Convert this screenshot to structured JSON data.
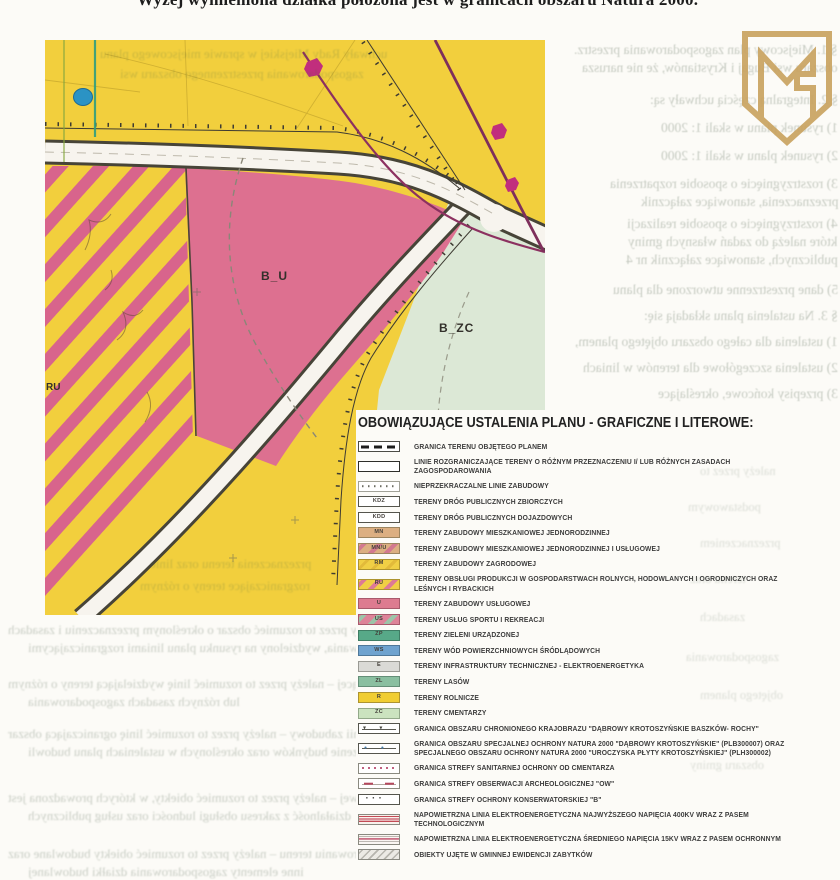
{
  "header": {
    "title": "Wyżej wymieniona działka położona jest w granicach obszaru Natura 2000."
  },
  "logo": {
    "name": "gold-shield-monogram",
    "color": "#C9A25E"
  },
  "map": {
    "area_labels": {
      "bu": "B_U",
      "bzc": "B_ZC",
      "ru": "RU"
    },
    "colors": {
      "farmland_yellow": "#F2CF3D",
      "services_pink": "#DD7090",
      "cemetery_green": "#DCE8D6",
      "hatch_stripe_pink": "#D8648C",
      "road_white": "#F7F4EE",
      "outline_dark": "#474438",
      "power_line_purple": "#8C3160",
      "monument_magenta": "#C12E7D",
      "pond_blue": "#2B93C4",
      "stream_teal": "#2F9E80"
    }
  },
  "legend": {
    "title": "OBOWIĄZUJĄCE USTALENIA PLANU - GRAFICZNE I LITEROWE:",
    "items": [
      {
        "swatch": "dash-bold",
        "code": "",
        "label": "GRANICA TERENU OBJĘTEGO PLANEM"
      },
      {
        "swatch": "outline",
        "code": "",
        "label": "LINIE ROZGRANICZAJĄCE TERENY O RÓŻNYM PRZEZNACZENIU I/ LUB RÓŻNYCH ZASADACH ZAGOSPODAROWANIA"
      },
      {
        "swatch": "dotted",
        "code": "",
        "label": "NIEPRZEKRACZALNE LINIE ZABUDOWY"
      },
      {
        "swatch": "road",
        "code": "KDZ",
        "label": "TERENY DRÓG PUBLICZNYCH ZBIORCZYCH"
      },
      {
        "swatch": "road",
        "code": "KDD",
        "label": "TERENY DRÓG PUBLICZNYCH DOJAZDOWYCH"
      },
      {
        "swatch": "fill-tan",
        "code": "MN",
        "label": "TERENY ZABUDOWY MIESZKANIOWEJ JEDNORODZINNEJ"
      },
      {
        "swatch": "fill-tan-stripe",
        "code": "MN/U",
        "label": "TERENY ZABUDOWY MIESZKANIOWEJ JEDNORODZINNEJ I USŁUGOWEJ"
      },
      {
        "swatch": "fill-yellow-soft",
        "code": "RM",
        "label": "TERENY ZABUDOWY ZAGRODOWEJ"
      },
      {
        "swatch": "fill-yellow-stripe-pink",
        "code": "RU",
        "label": "TERENY OBSŁUGI PRODUKCJI W GOSPODARSTWACH ROLNYCH, HODOWLANYCH I OGRODNICZYCH ORAZ LEŚNYCH I RYBACKICH"
      },
      {
        "swatch": "fill-pink",
        "code": "U",
        "label": "TERENY ZABUDOWY USŁUGOWEJ"
      },
      {
        "swatch": "fill-pink-stripe-green",
        "code": "US",
        "label": "TERENY USŁUG SPORTU I REKREACJI"
      },
      {
        "swatch": "fill-teal",
        "code": "ZP",
        "label": "TERENY ZIELENI URZĄDZONEJ"
      },
      {
        "swatch": "fill-blue",
        "code": "WS",
        "label": "TERENY WÓD POWIERZCHNIOWYCH ŚRÓDLĄDOWYCH"
      },
      {
        "swatch": "fill-gray",
        "code": "E",
        "label": "TERENY INFRASTRUKTURY TECHNICZNEJ - ELEKTROENERGETYKA"
      },
      {
        "swatch": "fill-green",
        "code": "ZL",
        "label": "TERENY LASÓW"
      },
      {
        "swatch": "fill-yellow",
        "code": "R",
        "label": "TERENY ROLNICZE"
      },
      {
        "swatch": "fill-lightgreen",
        "code": "ZC",
        "label": "TERENY CMENTARZY"
      },
      {
        "swatch": "marker-tri",
        "code": "",
        "label": "GRANICA OBSZARU CHRONIONEGO KRAJOBRAZU \"DĄBROWY KROTOSZYŃSKIE BASZKÓW- ROCHY\""
      },
      {
        "swatch": "marker-dot",
        "code": "",
        "label": "GRANICA OBSZARU SPECJALNEJ OCHRONY NATURA 2000 \"DĄBROWY KROTOSZYŃSKIE\" (PLB300007) ORAZ SPECJALNEGO OBSZARU OCHRONY NATURA 2000 \"UROCZYSKA PŁYTY KROTOSZYŃSKIEJ\" (PLH300002)"
      },
      {
        "swatch": "sanitary",
        "code": "",
        "label": "GRANICA STREFY SANITARNEJ OCHRONY OD CMENTARZA"
      },
      {
        "swatch": "arch",
        "code": "",
        "label": "GRANICA STREFY OBSERWACJI ARCHEOLOGICZNEJ \"OW\""
      },
      {
        "swatch": "conserv",
        "code": "",
        "label": "GRANICA STREFY OCHRONY KONSERWATORSKIEJ \"B\""
      },
      {
        "swatch": "hv400",
        "code": "",
        "label": "NAPOWIETRZNA LINIA ELEKTROENERGETYCZNA NAJWYŻSZEGO NAPIĘCIA 400KV WRAZ Z PASEM TECHNOLOGICZNYM"
      },
      {
        "swatch": "mv15",
        "code": "",
        "label": "NAPOWIETRZNA LINIA ELEKTROENERGETYCZNA ŚREDNIEGO NAPIĘCIA 15KV WRAZ Z PASEM OCHRONNYM"
      },
      {
        "swatch": "hatch-gray",
        "code": "",
        "label": "OBIEKTY UJĘTE W GMINNEJ EWIDENCJI ZABYTKÓW"
      }
    ]
  },
  "bleedthrough": {
    "note": "faint mirrored show-through text from reverse side of scanned page",
    "right_column": [
      {
        "y": 42,
        "r": 2,
        "t": "§ 1. Miejscowy plan zagospodarowania przestrz."
      },
      {
        "y": 60,
        "r": 2,
        "t": "obszaru wsi Bugaj i Krystianów, że nie narusza"
      },
      {
        "y": 92,
        "r": 2,
        "t": "§ 2. Integralną częścią uchwały są:"
      },
      {
        "y": 120,
        "r": 2,
        "t": "1) rysunek planu w skali 1: 2000"
      },
      {
        "y": 148,
        "r": 2,
        "t": "2) rysunek planu w skali 1: 2000"
      },
      {
        "y": 176,
        "r": 2,
        "t": "3) rozstrzygnięcie o sposobie rozpatrzenia"
      },
      {
        "y": 194,
        "r": 2,
        "t": "przeznaczenia, stanowiące załącznik"
      },
      {
        "y": 216,
        "r": 2,
        "t": "4) rozstrzygnięcie o sposobie realizacji"
      },
      {
        "y": 234,
        "r": 2,
        "t": "które należą do zadań własnych gminy"
      },
      {
        "y": 252,
        "r": 2,
        "t": "publicznych, stanowiące załącznik nr 4"
      },
      {
        "y": 282,
        "r": 2,
        "t": "5) dane przestrzenne utworzone dla planu"
      },
      {
        "y": 308,
        "r": 2,
        "t": "§ 3. Na ustalenia planu składają się:"
      },
      {
        "y": 334,
        "r": 2,
        "t": "1) ustalenia dla całego obszaru objętego planem,"
      },
      {
        "y": 360,
        "r": 2,
        "t": "2) ustalenia szczegółowe dla terenów w liniach"
      },
      {
        "y": 386,
        "r": 2,
        "t": "3) przepisy końcowe, określające"
      }
    ],
    "over_map": [
      {
        "y": 46,
        "x": 100,
        "t": "uchwały Rady Miejskiej w sprawie miejscowego planu"
      },
      {
        "y": 66,
        "x": 120,
        "t": "zagospodarowania przestrzennego obszaru wsi"
      },
      {
        "y": 556,
        "x": 150,
        "t": "przeznaczenia terenu oraz linie"
      },
      {
        "y": 578,
        "x": 140,
        "t": "rozgraniczające tereny o różnym"
      }
    ],
    "bottom": [
      {
        "y": 622,
        "x": 8,
        "t": "5) terenie – należy przez to rozumieć obszar o określonym przeznaczeniu i zasadach"
      },
      {
        "y": 640,
        "x": 28,
        "t": "zagospodarowania, wydzielony na rysunku planu liniami rozgraniczającymi"
      },
      {
        "y": 676,
        "x": 8,
        "t": "6) linii rozgraniczającej – należy przez to rozumieć linię wydzielającą tereny o różnym"
      },
      {
        "y": 694,
        "x": 28,
        "t": "lub różnych zasadach zagospodarowania"
      },
      {
        "y": 726,
        "x": 8,
        "t": "7) nieprzekraczalnej linii zabudowy – należy przez to rozumieć linię ograniczającą obszar"
      },
      {
        "y": 744,
        "x": 28,
        "t": "się wznoszenie budynków oraz określonych w ustaleniach planu budowli"
      },
      {
        "y": 790,
        "x": 8,
        "t": "9) zabudowie usługowej – należy przez to rozumieć obiekty, w których prowadzona jest"
      },
      {
        "y": 808,
        "x": 28,
        "t": "działalność z zakresu obsługi ludności oraz usług publicznych"
      },
      {
        "y": 846,
        "x": 8,
        "t": "10) zagospodarowaniu terenu – należy przez to rozumieć obiekty budowlane oraz"
      },
      {
        "y": 864,
        "x": 28,
        "t": "inne elementy zagospodarowania działki budowlanej"
      }
    ],
    "legend_area": [
      {
        "y": 464,
        "x": 700,
        "t": "należy przez to"
      },
      {
        "y": 500,
        "x": 688,
        "t": "podstawowym"
      },
      {
        "y": 536,
        "x": 700,
        "t": "przeznaczeniem"
      },
      {
        "y": 572,
        "x": 690,
        "t": "terenu oraz"
      },
      {
        "y": 610,
        "x": 700,
        "t": "zasadach"
      },
      {
        "y": 650,
        "x": 686,
        "t": "zagospodarowania"
      },
      {
        "y": 688,
        "x": 700,
        "t": "objętego planem"
      },
      {
        "y": 758,
        "x": 690,
        "t": "obszaru gminy"
      }
    ]
  }
}
